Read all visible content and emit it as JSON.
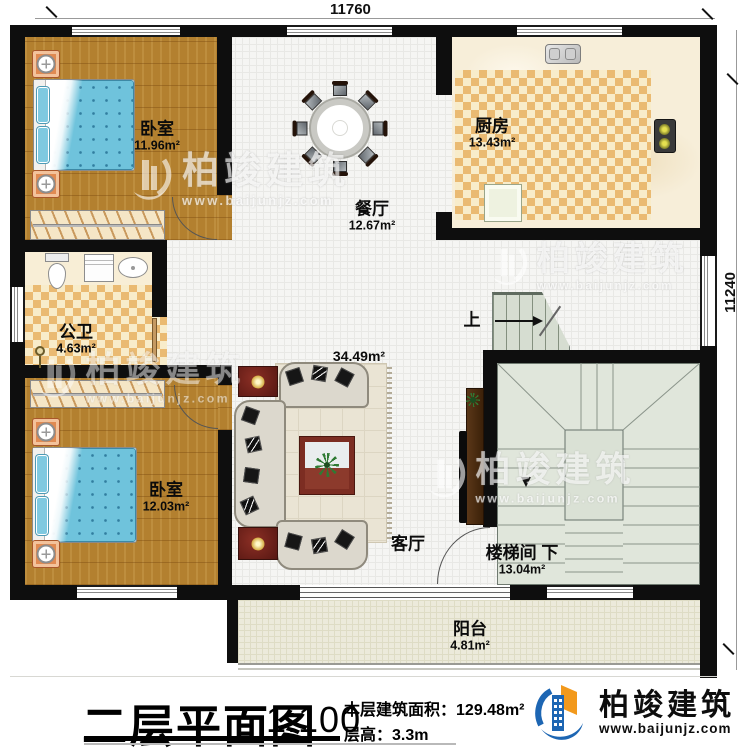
{
  "dimensions": {
    "width_mm": "11760",
    "height_mm": "11240"
  },
  "rooms": [
    {
      "name": "卧室",
      "area": "11.96m²"
    },
    {
      "name": "餐厅",
      "area": "12.67m²"
    },
    {
      "name": "厨房",
      "area": "13.43m²"
    },
    {
      "name": "公卫",
      "area": "4.63m²"
    },
    {
      "name": "卧室",
      "area": "12.03m²"
    },
    {
      "name": "客厅",
      "area": "34.49m²"
    },
    {
      "name": "楼梯间",
      "area": "13.04m²"
    },
    {
      "name": "阳台",
      "area": "4.81m²"
    }
  ],
  "stair_labels": {
    "up": "上",
    "down": "下"
  },
  "title_block": {
    "title": "二层平面图",
    "scale": "1:100",
    "area_label": "本层建筑面积：",
    "area_value": "129.48m²",
    "floor_height_label": "层高：",
    "floor_height_value": "3.3m"
  },
  "brand": {
    "name": "柏竣建筑",
    "website": "www.baijunjz.com"
  },
  "watermark": {
    "text": "柏竣建筑",
    "website": "www.baijunjz.com"
  },
  "colors": {
    "wall": "#0e0e0e",
    "wood_floor": "#b3802f",
    "checker_tile": "#eaba72",
    "stair_floor": "#e0e6db",
    "balcony_floor": "#eceadb",
    "brand_blue": "#1d66b3",
    "brand_orange": "#f2991c"
  }
}
